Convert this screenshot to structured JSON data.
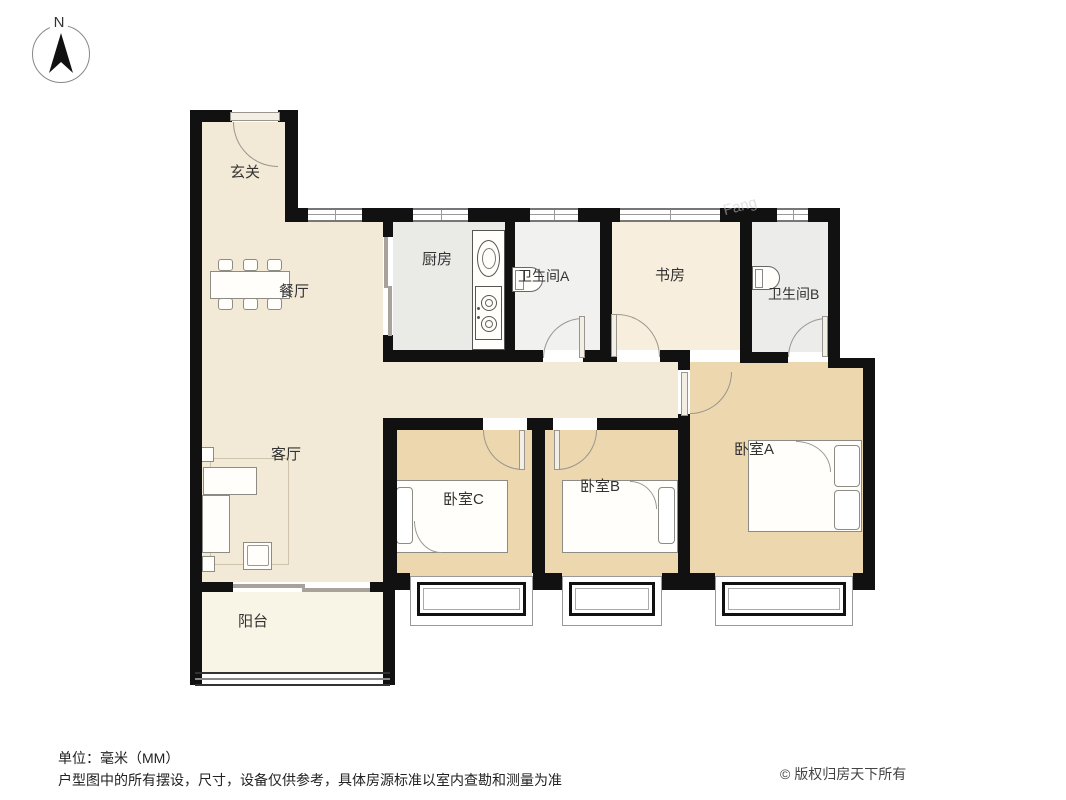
{
  "compass": {
    "label": "N"
  },
  "rooms": {
    "entry": {
      "label": "玄关"
    },
    "dining": {
      "label": "餐厅"
    },
    "kitchen": {
      "label": "厨房"
    },
    "bathroom_a": {
      "label": "卫生间A"
    },
    "study": {
      "label": "书房"
    },
    "bathroom_b": {
      "label": "卫生间B"
    },
    "living": {
      "label": "客厅"
    },
    "bedroom_c": {
      "label": "卧室C"
    },
    "bedroom_b": {
      "label": "卧室B"
    },
    "bedroom_a": {
      "label": "卧室A"
    },
    "balcony": {
      "label": "阳台"
    }
  },
  "footer": {
    "unit_note": "单位：毫米（MM）",
    "disclaimer": "户型图中的所有摆设，尺寸，设备仅供参考，具体房源标准以室内查勘和测量为准",
    "copyright": "© 版权归房天下所有"
  },
  "watermark": "Fang",
  "colors": {
    "wall": "#111111",
    "floor_cream": "#f3e9d7",
    "floor_tan": "#ecd7ae",
    "floor_kitchen": "#eaeae7",
    "floor_bath_a": "#f1f1ef",
    "floor_bath_b": "#ececea",
    "floor_study": "#f8eedd",
    "floor_balcony": "#f8f4e6",
    "door_line": "#9a958e",
    "furniture_line": "#8c8c84"
  }
}
